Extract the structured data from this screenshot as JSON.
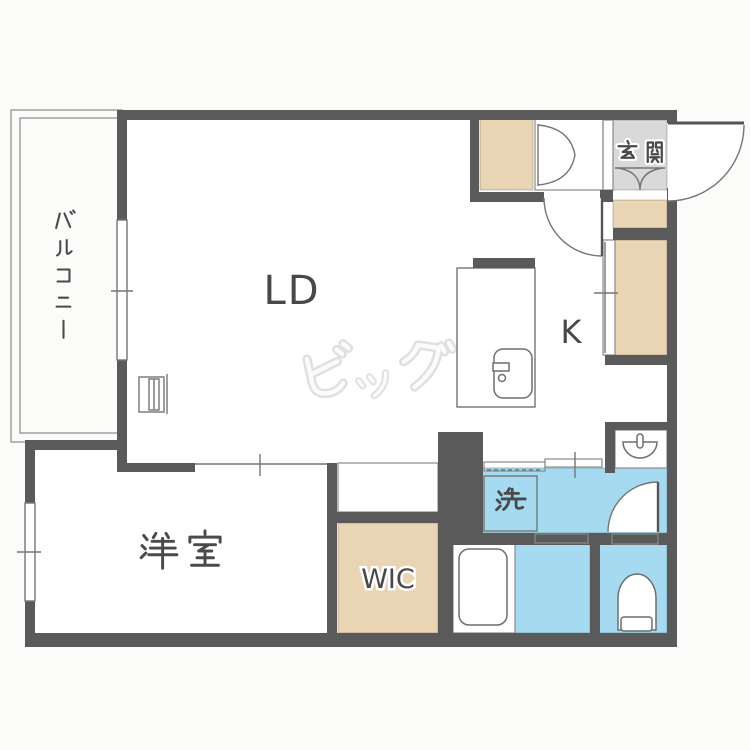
{
  "plan": {
    "rooms": {
      "living_dining": {
        "label": "LD"
      },
      "kitchen": {
        "label": "K"
      },
      "western_room": {
        "label": "洋室"
      },
      "walk_in_closet": {
        "label": "WIC"
      },
      "entrance": {
        "label": "玄関"
      },
      "laundry": {
        "label": "洗"
      },
      "balcony": {
        "label": "バルコニー"
      }
    },
    "watermark": {
      "label": "ビッグ"
    },
    "colors": {
      "wall": "#5a5a5a",
      "closet_beige": "#e9d4b3",
      "wet_area_blue": "#a5daf1",
      "entrance_gray": "#d9d9d9",
      "label_text": "#484848",
      "watermark_outline": "#e0e0e0",
      "floor_white": "#ffffff"
    }
  }
}
